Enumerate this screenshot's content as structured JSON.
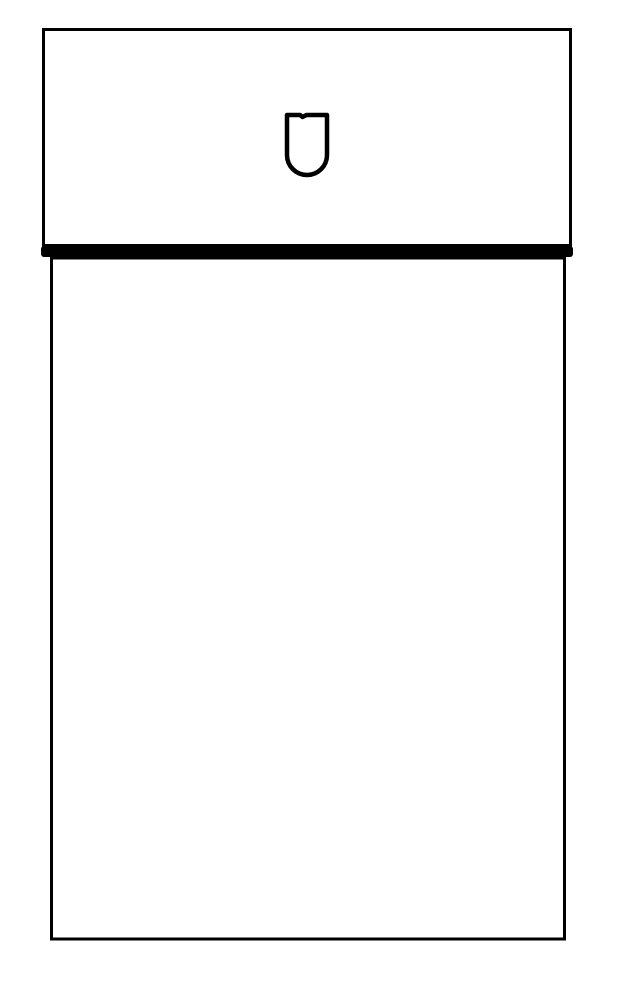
{
  "page": {
    "background": "#ffffff"
  },
  "drawing": {
    "description": "Front-view black line drawing of a two-part cabinet unit: a wide upper drawer panel with a U-shaped keyhole handle cutout at its center, a thick horizontal divider band, and a tall lower door panel below.",
    "line_color": "#000000",
    "canvas": {
      "width": 631,
      "height": 1000
    },
    "upper_panel": {
      "x": 43.5,
      "y": 29.5,
      "width": 527,
      "height": 216,
      "stroke_width": 3
    },
    "divider_band": {
      "x": 41,
      "y": 246,
      "width": 532,
      "height": 11,
      "corner_radius": 3
    },
    "lower_panel": {
      "x": 51.5,
      "y": 258,
      "width": 513,
      "height": 681,
      "stroke_width": 3
    },
    "handle_cutout": {
      "left": 287,
      "right": 327,
      "top": 115,
      "sides_bottom": 155,
      "radius": 20,
      "stroke_width": 4.5,
      "notch": {
        "x1": 300,
        "x2": 302.5,
        "x3": 306.5,
        "dip": 2
      }
    }
  }
}
